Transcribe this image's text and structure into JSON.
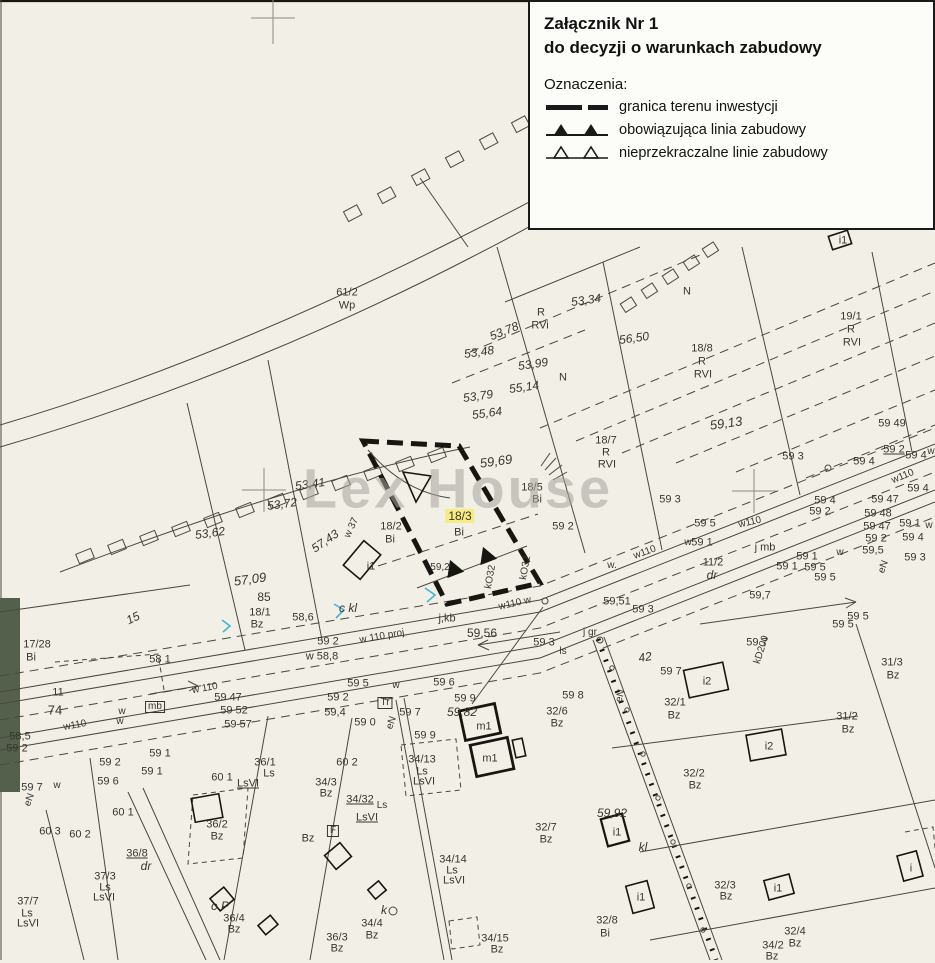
{
  "colors": {
    "paper": "#f2efe7",
    "ink": "#38362d",
    "line": "#4a483e",
    "bold": "#181611",
    "hl": "#f6ec82",
    "wm": "#a7a49d",
    "veg": "#55604c",
    "cyan": "#3fb6d8"
  },
  "legend": {
    "title_line1": "Załącznik Nr 1",
    "title_line2": "do decyzji o warunkach zabudowy",
    "symbols_heading": "Oznaczenia:",
    "items": [
      {
        "id": "granica-terenu-inwestycji",
        "label": "granica terenu inwestycji"
      },
      {
        "id": "obowiazujaca-linia-zabudowy",
        "label": "obowiązująca linia zabudowy"
      },
      {
        "id": "nieprzekraczalne-linie-zabudowy",
        "label": "nieprzekraczalne linie zabudowy"
      }
    ]
  },
  "watermark": "Lex House",
  "highlight_parcel": {
    "number": "18/3",
    "class_code": "Bi"
  },
  "map": {
    "labels": [
      {
        "t": "53,19",
        "x": 600,
        "y": 17,
        "r": -8,
        "c": "e"
      },
      {
        "t": "56,09",
        "x": 737,
        "y": 62,
        "r": -8,
        "c": "e"
      },
      {
        "t": "65",
        "x": 903,
        "y": 100,
        "r": -25,
        "c": "e"
      },
      {
        "t": "61/2",
        "x": 347,
        "y": 293
      },
      {
        "t": "Wp",
        "x": 347,
        "y": 306
      },
      {
        "t": "53,34",
        "x": 586,
        "y": 300,
        "r": -8,
        "c": "e"
      },
      {
        "t": "R",
        "x": 541,
        "y": 313
      },
      {
        "t": "RVi",
        "x": 540,
        "y": 326
      },
      {
        "t": "N",
        "x": 687,
        "y": 292
      },
      {
        "t": "56,50",
        "x": 634,
        "y": 338,
        "r": -8,
        "c": "e"
      },
      {
        "t": "19/1",
        "x": 851,
        "y": 317
      },
      {
        "t": "R",
        "x": 851,
        "y": 330
      },
      {
        "t": "RVI",
        "x": 852,
        "y": 343
      },
      {
        "t": "18/8",
        "x": 702,
        "y": 349
      },
      {
        "t": "R",
        "x": 702,
        "y": 362
      },
      {
        "t": "RVI",
        "x": 703,
        "y": 375
      },
      {
        "t": "53,99",
        "x": 533,
        "y": 364,
        "r": -8,
        "c": "e"
      },
      {
        "t": "N",
        "x": 563,
        "y": 378
      },
      {
        "t": "55,14",
        "x": 524,
        "y": 387,
        "r": -8,
        "c": "e"
      },
      {
        "t": "53,78",
        "x": 504,
        "y": 331,
        "r": -22,
        "c": "e"
      },
      {
        "t": "53,48",
        "x": 479,
        "y": 352,
        "r": -8,
        "c": "e"
      },
      {
        "t": "53,79",
        "x": 478,
        "y": 396,
        "r": -8,
        "c": "e"
      },
      {
        "t": "55,64",
        "x": 487,
        "y": 413,
        "r": -8,
        "c": "e"
      },
      {
        "t": "59,69",
        "x": 496,
        "y": 461,
        "r": -8,
        "c": "e",
        "s": 13
      },
      {
        "t": "18/7",
        "x": 606,
        "y": 441
      },
      {
        "t": "R",
        "x": 606,
        "y": 453
      },
      {
        "t": "RVI",
        "x": 607,
        "y": 465
      },
      {
        "t": "59,13",
        "x": 726,
        "y": 423,
        "r": -8,
        "c": "e",
        "s": 13
      },
      {
        "t": "59 3",
        "x": 793,
        "y": 457
      },
      {
        "t": "59 49",
        "x": 892,
        "y": 424
      },
      {
        "t": "59 2",
        "x": 894,
        "y": 450,
        "u": true
      },
      {
        "t": "59 4",
        "x": 916,
        "y": 456
      },
      {
        "t": "w",
        "x": 931,
        "y": 452,
        "c": "w"
      },
      {
        "t": "w110",
        "x": 903,
        "y": 477,
        "r": -22,
        "c": "w"
      },
      {
        "t": "59 4",
        "x": 918,
        "y": 489
      },
      {
        "t": "59 47",
        "x": 885,
        "y": 500
      },
      {
        "t": "59 48",
        "x": 878,
        "y": 514
      },
      {
        "t": "59 47",
        "x": 877,
        "y": 527
      },
      {
        "t": "59 1",
        "x": 910,
        "y": 524
      },
      {
        "t": "w",
        "x": 929,
        "y": 526,
        "c": "w"
      },
      {
        "t": "59 2",
        "x": 876,
        "y": 539
      },
      {
        "t": "59 4",
        "x": 913,
        "y": 538
      },
      {
        "t": "59,5",
        "x": 873,
        "y": 551
      },
      {
        "t": "59 3",
        "x": 915,
        "y": 558
      },
      {
        "t": "eN",
        "x": 884,
        "y": 567,
        "r": -70,
        "c": "w"
      },
      {
        "t": "59 5",
        "x": 858,
        "y": 617
      },
      {
        "t": "i1",
        "x": 843,
        "y": 241
      },
      {
        "t": "53,41",
        "x": 310,
        "y": 484,
        "r": -8,
        "c": "e"
      },
      {
        "t": "53,72",
        "x": 282,
        "y": 504,
        "r": -8,
        "c": "e"
      },
      {
        "t": "53,62",
        "x": 210,
        "y": 533,
        "r": -8,
        "c": "e"
      },
      {
        "t": "57,43",
        "x": 325,
        "y": 541,
        "r": -35,
        "c": "e"
      },
      {
        "t": "w 37",
        "x": 352,
        "y": 528,
        "r": -65,
        "c": "w"
      },
      {
        "t": "57,09",
        "x": 250,
        "y": 579,
        "r": -8,
        "c": "e",
        "s": 13
      },
      {
        "t": "85",
        "x": 264,
        "y": 597,
        "s": 12
      },
      {
        "t": "18/1",
        "x": 260,
        "y": 613
      },
      {
        "t": "Bz",
        "x": 257,
        "y": 625
      },
      {
        "t": "17/28",
        "x": 37,
        "y": 645
      },
      {
        "t": "Bi",
        "x": 31,
        "y": 658
      },
      {
        "t": "15",
        "x": 133,
        "y": 618,
        "r": -25,
        "c": "e"
      },
      {
        "t": "74",
        "x": 55,
        "y": 710,
        "s": 13
      },
      {
        "t": "11",
        "x": 58,
        "y": 693
      },
      {
        "t": "58,6",
        "x": 303,
        "y": 618
      },
      {
        "t": "c kl",
        "x": 348,
        "y": 608,
        "c": "e"
      },
      {
        "t": "58 1",
        "x": 160,
        "y": 660
      },
      {
        "t": "58,5",
        "x": 20,
        "y": 737
      },
      {
        "t": "59 2",
        "x": 17,
        "y": 749
      },
      {
        "t": "59 7",
        "x": 32,
        "y": 788
      },
      {
        "t": "w",
        "x": 57,
        "y": 786,
        "c": "w"
      },
      {
        "t": "eN",
        "x": 30,
        "y": 800,
        "r": -70,
        "c": "w"
      },
      {
        "t": "w110",
        "x": 75,
        "y": 726,
        "r": -10,
        "c": "w"
      },
      {
        "t": "w 110",
        "x": 205,
        "y": 689,
        "r": -10,
        "c": "w"
      },
      {
        "t": "mb",
        "x": 155,
        "y": 707,
        "c": "b"
      },
      {
        "t": "59 47",
        "x": 228,
        "y": 698
      },
      {
        "t": "59 52",
        "x": 234,
        "y": 711
      },
      {
        "t": "59 57",
        "x": 238,
        "y": 725
      },
      {
        "t": "w",
        "x": 122,
        "y": 712,
        "c": "w"
      },
      {
        "t": "w",
        "x": 120,
        "y": 722,
        "c": "w"
      },
      {
        "t": "59 1",
        "x": 160,
        "y": 754
      },
      {
        "t": "59 2",
        "x": 110,
        "y": 763
      },
      {
        "t": "59 1",
        "x": 152,
        "y": 772
      },
      {
        "t": "59 6",
        "x": 108,
        "y": 782
      },
      {
        "t": "w 110 proj",
        "x": 382,
        "y": 637,
        "r": -10,
        "c": "w"
      },
      {
        "t": "w110 w",
        "x": 515,
        "y": 604,
        "r": -13,
        "c": "w"
      },
      {
        "t": "j,kb",
        "x": 447,
        "y": 619
      },
      {
        "t": "59,56",
        "x": 482,
        "y": 633,
        "s": 12
      },
      {
        "t": "59 3",
        "x": 544,
        "y": 643
      },
      {
        "t": "w 58,8",
        "x": 322,
        "y": 657
      },
      {
        "t": "59 2",
        "x": 328,
        "y": 642
      },
      {
        "t": "59 5",
        "x": 358,
        "y": 684
      },
      {
        "t": "w",
        "x": 396,
        "y": 686,
        "c": "w"
      },
      {
        "t": "59 6",
        "x": 444,
        "y": 683
      },
      {
        "t": "59 2",
        "x": 338,
        "y": 698
      },
      {
        "t": "59,4",
        "x": 335,
        "y": 713
      },
      {
        "t": "59 0",
        "x": 365,
        "y": 723
      },
      {
        "t": "59 7",
        "x": 410,
        "y": 713
      },
      {
        "t": "eN",
        "x": 392,
        "y": 723,
        "r": -70,
        "c": "w"
      },
      {
        "t": "Tr",
        "x": 385,
        "y": 703,
        "c": "b"
      },
      {
        "t": "59 9",
        "x": 465,
        "y": 699
      },
      {
        "t": "59,82",
        "x": 462,
        "y": 712,
        "c": "e"
      },
      {
        "t": "59 9",
        "x": 425,
        "y": 736
      },
      {
        "t": "59,51",
        "x": 617,
        "y": 602
      },
      {
        "t": "59 3",
        "x": 643,
        "y": 610
      },
      {
        "t": "j gr",
        "x": 590,
        "y": 633,
        "c": "w"
      },
      {
        "t": "ls",
        "x": 563,
        "y": 652,
        "c": "w"
      },
      {
        "t": "42",
        "x": 645,
        "y": 657,
        "r": -10,
        "c": "e"
      },
      {
        "t": "59 8",
        "x": 573,
        "y": 696
      },
      {
        "t": "32/6",
        "x": 557,
        "y": 712
      },
      {
        "t": "Bz",
        "x": 557,
        "y": 724
      },
      {
        "t": "kD200",
        "x": 762,
        "y": 650,
        "r": -72,
        "c": "w"
      },
      {
        "t": "j mb",
        "x": 765,
        "y": 548
      },
      {
        "t": "11/2",
        "x": 713,
        "y": 563
      },
      {
        "t": "dr",
        "x": 712,
        "y": 575,
        "c": "e"
      },
      {
        "t": "59,7",
        "x": 760,
        "y": 596
      },
      {
        "t": "59 1",
        "x": 807,
        "y": 557
      },
      {
        "t": "59 1",
        "x": 787,
        "y": 567
      },
      {
        "t": "59 5",
        "x": 815,
        "y": 568
      },
      {
        "t": "59 5",
        "x": 825,
        "y": 578
      },
      {
        "t": "w",
        "x": 840,
        "y": 553,
        "c": "w"
      },
      {
        "t": "59 5",
        "x": 705,
        "y": 524
      },
      {
        "t": "59 1",
        "x": 702,
        "y": 543
      },
      {
        "t": "w",
        "x": 688,
        "y": 543,
        "c": "w"
      },
      {
        "t": "w110",
        "x": 645,
        "y": 553,
        "r": -20,
        "c": "w"
      },
      {
        "t": "w110",
        "x": 750,
        "y": 523,
        "r": -13,
        "c": "w"
      },
      {
        "t": "59 4",
        "x": 825,
        "y": 501
      },
      {
        "t": "59 2",
        "x": 820,
        "y": 512
      },
      {
        "t": "59 4",
        "x": 864,
        "y": 462
      },
      {
        "t": "59 3",
        "x": 670,
        "y": 500
      },
      {
        "t": "w.",
        "x": 612,
        "y": 566,
        "c": "w"
      },
      {
        "t": "59,2",
        "x": 440,
        "y": 568,
        "c": "w"
      },
      {
        "t": "kO32",
        "x": 491,
        "y": 577,
        "r": -80,
        "c": "w"
      },
      {
        "t": "kO32",
        "x": 526,
        "y": 568,
        "r": -80,
        "c": "w"
      },
      {
        "t": "18/2",
        "x": 391,
        "y": 527
      },
      {
        "t": "Bi",
        "x": 390,
        "y": 540
      },
      {
        "t": "18/3",
        "x": 460,
        "y": 516,
        "hl": true,
        "s": 12
      },
      {
        "t": "Bi",
        "x": 459,
        "y": 533
      },
      {
        "t": "18/5",
        "x": 532,
        "y": 488
      },
      {
        "t": "Bi",
        "x": 537,
        "y": 500
      },
      {
        "t": "59 2",
        "x": 563,
        "y": 527
      },
      {
        "t": "i1",
        "x": 371,
        "y": 567
      },
      {
        "t": "60 2",
        "x": 347,
        "y": 763
      },
      {
        "t": "34/3",
        "x": 326,
        "y": 783
      },
      {
        "t": "Bz",
        "x": 326,
        "y": 794
      },
      {
        "t": "34/13",
        "x": 422,
        "y": 760
      },
      {
        "t": "Ls",
        "x": 422,
        "y": 772
      },
      {
        "t": "LsVI",
        "x": 424,
        "y": 782
      },
      {
        "t": "34/32",
        "x": 360,
        "y": 800,
        "u": true
      },
      {
        "t": "Ls",
        "x": 382,
        "y": 806,
        "c": "w"
      },
      {
        "t": "LsVI",
        "x": 367,
        "y": 818,
        "u": true
      },
      {
        "t": "Bz",
        "x": 308,
        "y": 839
      },
      {
        "t": "m1",
        "x": 484,
        "y": 727
      },
      {
        "t": "m1",
        "x": 490,
        "y": 759
      },
      {
        "t": "34/14",
        "x": 453,
        "y": 860
      },
      {
        "t": "Ls",
        "x": 452,
        "y": 871
      },
      {
        "t": "LsVI",
        "x": 454,
        "y": 881
      },
      {
        "t": "k",
        "x": 384,
        "y": 910,
        "c": "e"
      },
      {
        "t": "34/4",
        "x": 372,
        "y": 924
      },
      {
        "t": "Bz",
        "x": 372,
        "y": 936
      },
      {
        "t": "36/3",
        "x": 337,
        "y": 938
      },
      {
        "t": "Bz",
        "x": 337,
        "y": 949
      },
      {
        "t": "34/15",
        "x": 495,
        "y": 939
      },
      {
        "t": "Bz",
        "x": 497,
        "y": 950
      },
      {
        "t": "32/7",
        "x": 546,
        "y": 828
      },
      {
        "t": "Bz",
        "x": 546,
        "y": 840
      },
      {
        "t": "F",
        "x": 333,
        "y": 831,
        "c": "b"
      },
      {
        "t": "32/1",
        "x": 675,
        "y": 703
      },
      {
        "t": "Bz",
        "x": 674,
        "y": 716
      },
      {
        "t": "32/2",
        "x": 694,
        "y": 774
      },
      {
        "t": "Bz",
        "x": 695,
        "y": 786
      },
      {
        "t": "i2",
        "x": 707,
        "y": 682
      },
      {
        "t": "i2",
        "x": 769,
        "y": 747
      },
      {
        "t": "59 7",
        "x": 671,
        "y": 672
      },
      {
        "t": "59 7",
        "x": 757,
        "y": 643
      },
      {
        "t": "59 5",
        "x": 843,
        "y": 625
      },
      {
        "t": "31/3",
        "x": 892,
        "y": 663
      },
      {
        "t": "Bz",
        "x": 893,
        "y": 676
      },
      {
        "t": "31/2",
        "x": 847,
        "y": 717
      },
      {
        "t": "Bz",
        "x": 848,
        "y": 730
      },
      {
        "t": "59,92",
        "x": 612,
        "y": 813,
        "c": "e"
      },
      {
        "t": "i1",
        "x": 617,
        "y": 833
      },
      {
        "t": "kl",
        "x": 643,
        "y": 847,
        "c": "e"
      },
      {
        "t": "32/3",
        "x": 725,
        "y": 886
      },
      {
        "t": "Bz",
        "x": 726,
        "y": 897
      },
      {
        "t": "i1",
        "x": 778,
        "y": 889
      },
      {
        "t": "i1",
        "x": 641,
        "y": 898
      },
      {
        "t": "32/8",
        "x": 607,
        "y": 921
      },
      {
        "t": "Bi",
        "x": 605,
        "y": 934
      },
      {
        "t": "32/4",
        "x": 795,
        "y": 932
      },
      {
        "t": "Bz",
        "x": 795,
        "y": 944
      },
      {
        "t": "i",
        "x": 911,
        "y": 869
      },
      {
        "t": "eN",
        "x": 621,
        "y": 696,
        "r": -75,
        "c": "w"
      },
      {
        "t": "34/2",
        "x": 773,
        "y": 946
      },
      {
        "t": "Bz",
        "x": 772,
        "y": 957
      },
      {
        "t": "60 1",
        "x": 222,
        "y": 778
      },
      {
        "t": "36/1",
        "x": 265,
        "y": 763
      },
      {
        "t": "Ls",
        "x": 269,
        "y": 774
      },
      {
        "t": "LsVI",
        "x": 248,
        "y": 784,
        "u": true
      },
      {
        "t": "60 1",
        "x": 123,
        "y": 813
      },
      {
        "t": "60 3",
        "x": 50,
        "y": 832
      },
      {
        "t": "60 2",
        "x": 80,
        "y": 835
      },
      {
        "t": "36/8",
        "x": 137,
        "y": 854,
        "u": true
      },
      {
        "t": "dr",
        "x": 146,
        "y": 866,
        "c": "e"
      },
      {
        "t": "36/2",
        "x": 217,
        "y": 825
      },
      {
        "t": "Bz",
        "x": 217,
        "y": 837
      },
      {
        "t": "37/3",
        "x": 105,
        "y": 877
      },
      {
        "t": "Ls",
        "x": 105,
        "y": 888
      },
      {
        "t": "LsVI",
        "x": 104,
        "y": 898
      },
      {
        "t": "37/7",
        "x": 28,
        "y": 902
      },
      {
        "t": "Ls",
        "x": 27,
        "y": 914
      },
      {
        "t": "LsVI",
        "x": 28,
        "y": 924
      },
      {
        "t": "o P",
        "x": 220,
        "y": 906,
        "c": "e"
      },
      {
        "t": "36/4",
        "x": 234,
        "y": 919
      },
      {
        "t": "Bz",
        "x": 234,
        "y": 930
      }
    ]
  }
}
